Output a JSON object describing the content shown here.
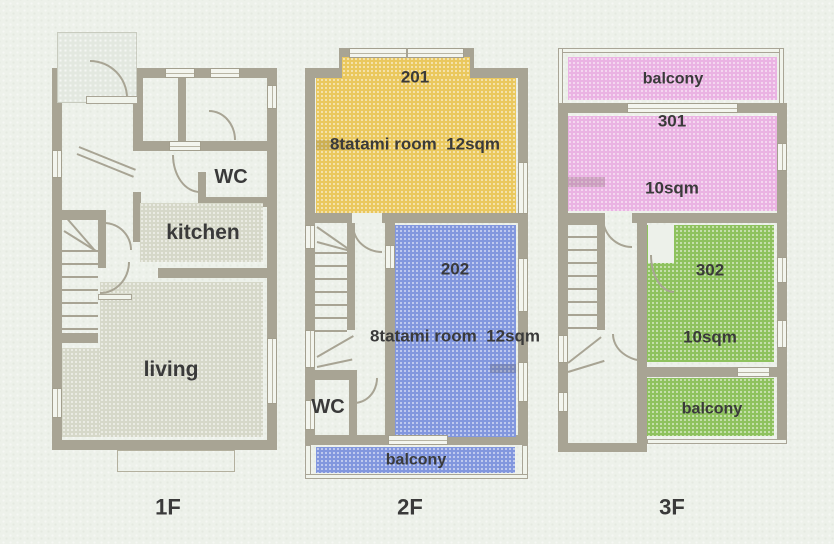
{
  "palette": {
    "background": "#edf1ea",
    "wall": "#a8a494",
    "text": "#3a3a3a",
    "room_gray": "#d6d8c9",
    "porch": "#e3e8e0",
    "room_yellow": "#eac85e",
    "room_blue": "#8297de",
    "room_pink": "#eab3e3",
    "room_green": "#8ec25e"
  },
  "floor_1f": {
    "label": "1F",
    "rooms": {
      "wc": {
        "label": "WC"
      },
      "kitchen": {
        "label": "kitchen",
        "color": "#d6d8c9"
      },
      "living": {
        "label": "living",
        "color": "#d6d8c9"
      },
      "porch": {
        "color": "#e3e8e0"
      }
    }
  },
  "floor_2f": {
    "label": "2F",
    "rooms": {
      "r201": {
        "number": "201",
        "desc": "8tatami room  12sqm",
        "color": "#eac85e"
      },
      "r202": {
        "number": "202",
        "desc": "8tatami room  12sqm",
        "color": "#8297de"
      },
      "wc": {
        "label": "WC"
      },
      "balcony": {
        "label": "balcony",
        "color": "#8297de"
      }
    }
  },
  "floor_3f": {
    "label": "3F",
    "rooms": {
      "balcony_north": {
        "label": "balcony",
        "color": "#eab3e3"
      },
      "r301": {
        "number": "301",
        "desc": "10sqm",
        "color": "#eab3e3"
      },
      "r302": {
        "number": "302",
        "desc": "10sqm",
        "color": "#8ec25e"
      },
      "balcony_south": {
        "label": "balcony",
        "color": "#8ec25e"
      }
    }
  }
}
